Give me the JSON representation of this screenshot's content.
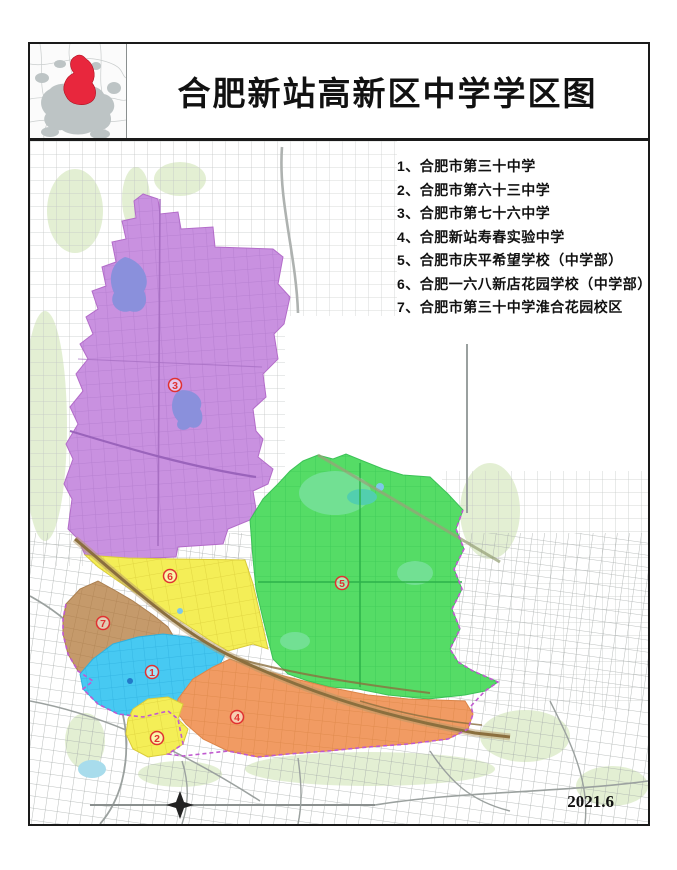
{
  "window": {
    "title": "合肥新站高新区中学学区图",
    "date": "2021.6"
  },
  "legend": {
    "items": [
      {
        "text": "1、合肥市第三十中学"
      },
      {
        "text": "2、合肥市第六十三中学"
      },
      {
        "text": "3、合肥市第七十六中学"
      },
      {
        "text": "4、合肥新站寿春实验中学"
      },
      {
        "text": "5、合肥市庆平希望学校（中学部）"
      },
      {
        "text": "6、合肥一六八新店花园学校（中学部）"
      },
      {
        "text": "7、合肥市第三十中学淮合花园校区"
      }
    ]
  },
  "map": {
    "regions": [
      {
        "num": "1",
        "school": "合肥市第三十中学",
        "color": "#47c9f2"
      },
      {
        "num": "2",
        "school": "合肥市第六十三中学",
        "color": "#f4ee57"
      },
      {
        "num": "3",
        "school": "合肥市第七十六中学",
        "color": "#c991e0"
      },
      {
        "num": "4",
        "school": "合肥新站寿春实验中学",
        "color": "#f19b63"
      },
      {
        "num": "5",
        "school": "合肥市庆平希望学校（中学部）",
        "color": "#55dc66"
      },
      {
        "num": "6",
        "school": "合肥一六八新店花园学校（中学部）",
        "color": "#f4ee57"
      },
      {
        "num": "7",
        "school": "合肥市第三十中学淮合花园校区",
        "color": "#c59a6b"
      }
    ],
    "marker_color": "#e03131",
    "lake_color": "#8a90dc",
    "park_color": "#72e093",
    "railway_color": "#8b6f3e",
    "boundary_color": "#c05ad0",
    "road_gray": "#c4c7c6",
    "inset_highlight_color": "#e8273d"
  }
}
